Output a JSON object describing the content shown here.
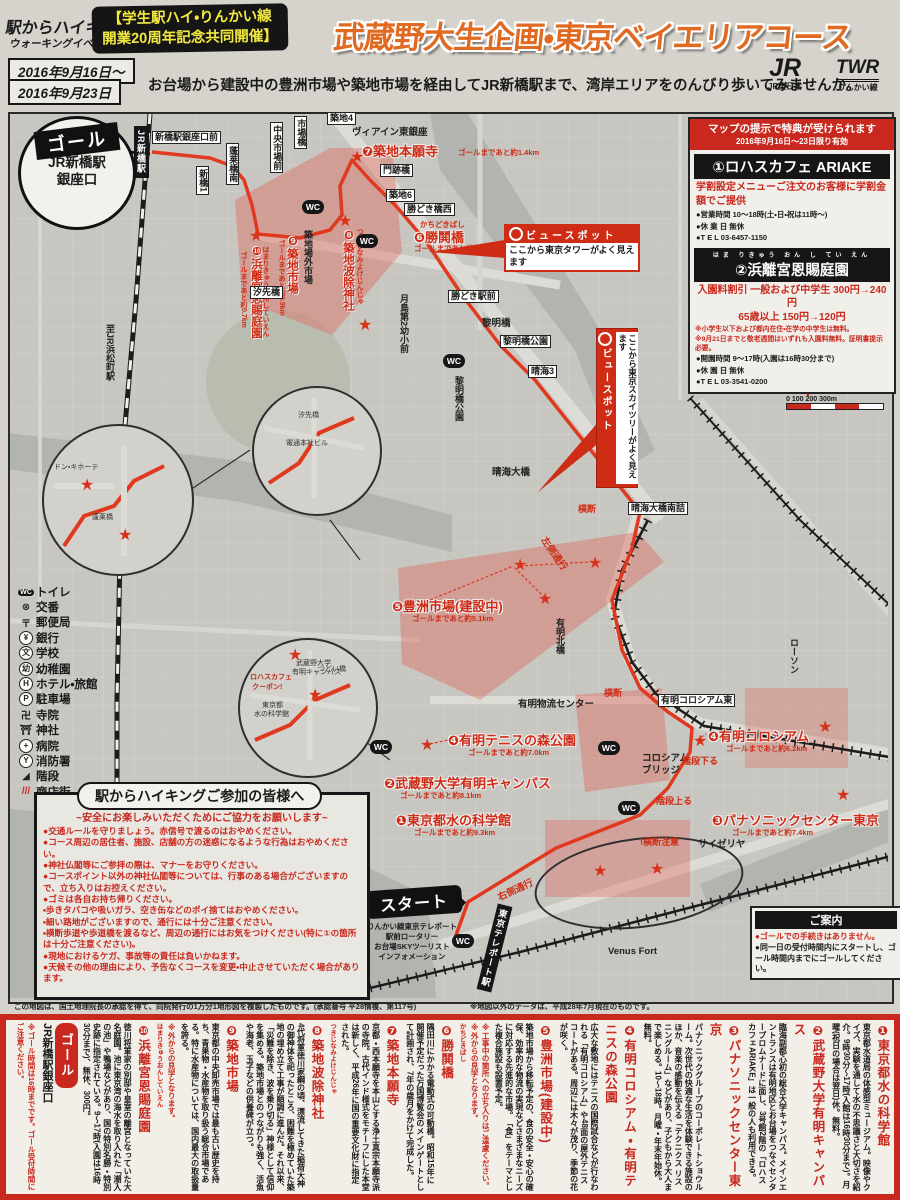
{
  "header": {
    "logo_line1": "駅からハイキング&",
    "logo_line2": "ウォーキングイベント",
    "coop_line1": "【学生駅ハイ・りんかい線",
    "coop_line2": "開業20周年記念共同開催】",
    "title": "武蔵野大生企画・東京ベイエリアコース",
    "date_line1": "2016年9月16日〜",
    "date_line2": "2016年9月23日",
    "subtitle": "お台場から建設中の豊洲市場や築地市場を経由してJR新橋駅まで、湾岸エリアをのんびり歩いてみませんか。",
    "jr_mark": "JR",
    "jr_label": "JR東日本",
    "twr_mark": "TWR",
    "twr_label": "りんかい線"
  },
  "promo": {
    "header_line1": "マップの提示で特典が受けられます",
    "header_line2": "2016年9月16日〜23日限り有効",
    "shop1_title": "①ロハスカフェ ARIAKE",
    "shop1_offer": "学割設定メニューご注文のお客様に学割金額でご提供",
    "shop1_hours": "●営業時間 10〜18時(土・日・祝は11時〜)",
    "shop1_closed": "●休 業 日 無休",
    "shop1_tel": "●T E L 03-6457-1150",
    "shop2_furigana": "はま りきゅう おん し てい えん",
    "shop2_title": "②浜離宮恩賜庭園",
    "shop2_offer1": "入園料割引 一般および中学生 300円→240円",
    "shop2_offer2": "65歳以上 150円→120円",
    "shop2_note1": "※小学生以下および都内在住・在学の中学生は無料。",
    "shop2_note2": "※9月21日までと敬老週間はいずれも入園料無料。証明書提示必要。",
    "shop2_hours": "●開園時間 9〜17時(入園は16時30分まで)",
    "shop2_closed": "●休 園 日 無休",
    "shop2_tel": "●T E L 03-3541-0200"
  },
  "goal_callout": {
    "badge": "ゴール",
    "line1": "JR新橋駅",
    "line2": "銀座口"
  },
  "start_callout": {
    "badge": "スタート",
    "sub1": "りんかい線東京テレポート",
    "sub2": "駅前ロータリー",
    "sub3": "お台場SKYツーリスト",
    "sub4": "インフォメーション"
  },
  "viewspot1": {
    "title": "ビュースポット",
    "body": "ここから東京タワーがよく見えます"
  },
  "viewspot2": {
    "title": "ビュースポット",
    "body": "ここから東京スカイツリーがよく見えます"
  },
  "compass": {
    "label": "北"
  },
  "scale": {
    "ticks": "0   100   200  300m"
  },
  "legend": {
    "items": [
      {
        "icon": "WC",
        "label": "トイレ"
      },
      {
        "icon": "⊗",
        "label": "交番"
      },
      {
        "icon": "〒",
        "label": "郵便局"
      },
      {
        "icon": "¥",
        "label": "銀行"
      },
      {
        "icon": "文",
        "label": "学校"
      },
      {
        "icon": "幼",
        "label": "幼稚園"
      },
      {
        "icon": "H",
        "label": "ホテル・旅館"
      },
      {
        "icon": "P",
        "label": "駐車場"
      },
      {
        "icon": "卍",
        "label": "寺院"
      },
      {
        "icon": "⛩",
        "label": "神社"
      },
      {
        "icon": "+",
        "label": "病院"
      },
      {
        "icon": "Y",
        "label": "消防署"
      },
      {
        "icon": "◢",
        "label": "階段"
      },
      {
        "icon": "///",
        "label": "商店街"
      }
    ]
  },
  "safety": {
    "title": "駅からハイキングご参加の皆様へ",
    "subtitle": "~安全にお楽しみいただくためにご協力をお願いします~",
    "bullets": [
      "●交通ルールを守りましょう。赤信号で渡るのはおやめください。",
      "●コース周辺の居住者、施設、店舗の方の迷惑になるような行為はおやめください。",
      "●神社仏閣等にご参拝の際は、マナーをお守りください。",
      "●コースポイント以外の神社仏閣等については、行事のある場合がございますので、立ち入りはお控えください。",
      "●ゴミは各自お持ち帰りください。",
      "・歩きタバコや吸いガラ、空き缶などのポイ捨てはおやめください。",
      "・細い路地がございますので、通行には十分ご注意ください。",
      "・横断歩道や歩道橋を渡るなど、周辺の通行にはお気をつけください(特に①の箇所は十分ご注意ください)。",
      "●現地におけるケガ、事故等の責任は負いかねます。",
      "●天候その他の理由により、予告なくコースを変更・中止させていただく場合があります。"
    ]
  },
  "guide": {
    "title": "ご案内",
    "line1": "●ゴールでの手続きはありません。",
    "line2": "●同一日の受付時間内にスタートし、ゴール時間内までにゴールしてください。"
  },
  "map_notes": {
    "left": "この地図は、国土地理院長の承認を得て、同院発行の1万分1地形図を複製したものです。(承認番号 平28情複、第117号)",
    "right": "※地図以外のデータは、平成28年7月現在のものです。"
  },
  "map": {
    "labels": [
      {
        "t": "新橋駅銀座口前",
        "x": 152,
        "y": 131,
        "s": "box"
      },
      {
        "t": "新橋1",
        "x": 196,
        "y": 166,
        "s": "vbox"
      },
      {
        "t": "蓬莱橋南",
        "x": 226,
        "y": 143,
        "s": "vbox"
      },
      {
        "t": "中央市場前",
        "x": 270,
        "y": 122,
        "s": "vbox"
      },
      {
        "t": "市場橋",
        "x": 294,
        "y": 116,
        "s": "vbox"
      },
      {
        "t": "築地4",
        "x": 327,
        "y": 112,
        "s": "box"
      },
      {
        "t": "ヴィアイン東銀座",
        "x": 352,
        "y": 124,
        "s": "plain"
      },
      {
        "t": "❼築地本願寺",
        "x": 362,
        "y": 141,
        "s": "red"
      },
      {
        "t": "ゴールまであと約1.4km",
        "x": 458,
        "y": 147,
        "s": "redsub"
      },
      {
        "t": "門跡橋",
        "x": 380,
        "y": 164,
        "s": "box"
      },
      {
        "t": "築地6",
        "x": 386,
        "y": 189,
        "s": "box"
      },
      {
        "t": "勝どき橋西",
        "x": 404,
        "y": 203,
        "s": "box"
      },
      {
        "t": "かちどきばし",
        "x": 420,
        "y": 219,
        "s": "redsub"
      },
      {
        "t": "❻勝鬨橋",
        "x": 414,
        "y": 227,
        "s": "red"
      },
      {
        "t": "ゴールまであと約2.4km",
        "x": 414,
        "y": 243,
        "s": "redsub"
      },
      {
        "t": "築地場外市場",
        "x": 302,
        "y": 230,
        "s": "vplain"
      },
      {
        "t": "つきじなみよけじんじゃ",
        "x": 354,
        "y": 228,
        "s": "vredsub"
      },
      {
        "t": "❽築地波除神社",
        "x": 340,
        "y": 228,
        "s": "vred"
      },
      {
        "t": "❾築地市場",
        "x": 284,
        "y": 234,
        "s": "vred"
      },
      {
        "t": "ゴールまであと約0.9km",
        "x": 276,
        "y": 240,
        "s": "vredsub"
      },
      {
        "t": "はまりきゅうおんしていえん",
        "x": 260,
        "y": 246,
        "s": "vredsub"
      },
      {
        "t": "❿浜離宮恩賜庭園",
        "x": 248,
        "y": 244,
        "s": "vred"
      },
      {
        "t": "ゴールまであと約0.7km",
        "x": 238,
        "y": 252,
        "s": "vredsub"
      },
      {
        "t": "汐先橋",
        "x": 250,
        "y": 286,
        "s": "box"
      },
      {
        "t": "月島第2幼小前",
        "x": 398,
        "y": 294,
        "s": "vplain"
      },
      {
        "t": "勝どき駅前",
        "x": 448,
        "y": 290,
        "s": "box"
      },
      {
        "t": "黎明橋",
        "x": 482,
        "y": 315,
        "s": "plain"
      },
      {
        "t": "黎明橋公園",
        "x": 500,
        "y": 335,
        "s": "box"
      },
      {
        "t": "黎明橋公園",
        "x": 453,
        "y": 376,
        "s": "vplain"
      },
      {
        "t": "晴海3",
        "x": 528,
        "y": 365,
        "s": "box"
      },
      {
        "t": "晴海大橋",
        "x": 492,
        "y": 464,
        "s": "plain"
      },
      {
        "t": "横断",
        "x": 578,
        "y": 502,
        "s": "redsmall"
      },
      {
        "t": "晴海大橋南詰",
        "x": 628,
        "y": 502,
        "s": "box"
      },
      {
        "t": "❺豊洲市場(建設中)",
        "x": 392,
        "y": 596,
        "s": "red"
      },
      {
        "t": "ゴールまであと約5.1km",
        "x": 412,
        "y": 613,
        "s": "redsub"
      },
      {
        "t": "左側通行",
        "x": 536,
        "y": 546,
        "s": "redrot",
        "r": 55
      },
      {
        "t": "有明北橋",
        "x": 554,
        "y": 618,
        "s": "vplain"
      },
      {
        "t": "ローソン",
        "x": 788,
        "y": 638,
        "s": "vplain"
      },
      {
        "t": "有明物流センター",
        "x": 518,
        "y": 696,
        "s": "plain"
      },
      {
        "t": "横断",
        "x": 604,
        "y": 686,
        "s": "redsmall"
      },
      {
        "t": "有明コロシアム東",
        "x": 658,
        "y": 694,
        "s": "box"
      },
      {
        "t": "❹有明テニスの森公園",
        "x": 448,
        "y": 730,
        "s": "red"
      },
      {
        "t": "ゴールまであと約7.0km",
        "x": 468,
        "y": 747,
        "s": "redsub"
      },
      {
        "t": "❷武蔵野大学有明キャンパス",
        "x": 384,
        "y": 773,
        "s": "red"
      },
      {
        "t": "ゴールまであと約8.1km",
        "x": 400,
        "y": 790,
        "s": "redsub"
      },
      {
        "t": "❶東京都水の科学館",
        "x": 396,
        "y": 810,
        "s": "red"
      },
      {
        "t": "ゴールまであと約9.3km",
        "x": 414,
        "y": 827,
        "s": "redsub"
      },
      {
        "t": "コロシアム",
        "x": 642,
        "y": 750,
        "s": "plain"
      },
      {
        "t": "ブリッジ",
        "x": 642,
        "y": 762,
        "s": "plain"
      },
      {
        "t": "❹有明コロシアム",
        "x": 708,
        "y": 726,
        "s": "red"
      },
      {
        "t": "ゴールまであと約6.2km",
        "x": 726,
        "y": 743,
        "s": "redsub"
      },
      {
        "t": "階段下る",
        "x": 682,
        "y": 754,
        "s": "redsmall"
      },
      {
        "t": "階段上る",
        "x": 656,
        "y": 794,
        "s": "redsmall"
      },
      {
        "t": "!横断注意",
        "x": 640,
        "y": 835,
        "s": "redsmall"
      },
      {
        "t": "❸パナソニックセンター東京",
        "x": 712,
        "y": 810,
        "s": "red"
      },
      {
        "t": "ゴールまであと約7.4km",
        "x": 732,
        "y": 827,
        "s": "redsub"
      },
      {
        "t": "サイゼリヤ",
        "x": 698,
        "y": 836,
        "s": "plain"
      },
      {
        "t": "右側通行",
        "x": 496,
        "y": 882,
        "s": "redrot",
        "r": -25
      },
      {
        "t": "Venus Fort",
        "x": 608,
        "y": 946,
        "s": "plain"
      },
      {
        "t": "至JR浜松町駅",
        "x": 104,
        "y": 324,
        "s": "vplain"
      },
      {
        "t": "東京テレポート駅",
        "x": 487,
        "y": 904,
        "s": "vstation",
        "r": 14
      },
      {
        "t": "JR新橋駅",
        "x": 134,
        "y": 126,
        "s": "vstation"
      },
      {
        "t": "ドン・キホーテ",
        "x": 54,
        "y": 462,
        "s": "tiny"
      },
      {
        "t": "蓬莱橋",
        "x": 92,
        "y": 512,
        "s": "tiny"
      },
      {
        "t": "電通本社ビル",
        "x": 286,
        "y": 438,
        "s": "tiny"
      },
      {
        "t": "汐先橋",
        "x": 298,
        "y": 410,
        "s": "tiny"
      },
      {
        "t": "武蔵野大学",
        "x": 296,
        "y": 658,
        "s": "tiny"
      },
      {
        "t": "有明キャンパス",
        "x": 292,
        "y": 667,
        "s": "tiny"
      },
      {
        "t": "ロハスカフェ",
        "x": 250,
        "y": 672,
        "s": "tinyred"
      },
      {
        "t": "クーポン!",
        "x": 252,
        "y": 682,
        "s": "tinyred"
      },
      {
        "t": "東京都",
        "x": 262,
        "y": 700,
        "s": "tiny"
      },
      {
        "t": "水の科学館",
        "x": 254,
        "y": 709,
        "s": "tiny"
      },
      {
        "t": "つどい橋",
        "x": 318,
        "y": 664,
        "s": "tiny"
      },
      {
        "t": "★",
        "x": 249,
        "y": 229,
        "s": "star"
      },
      {
        "t": "★",
        "x": 338,
        "y": 214,
        "s": "star"
      },
      {
        "t": "★",
        "x": 350,
        "y": 150,
        "s": "star"
      },
      {
        "t": "★",
        "x": 358,
        "y": 318,
        "s": "star"
      },
      {
        "t": "★",
        "x": 513,
        "y": 558,
        "s": "star"
      },
      {
        "t": "★",
        "x": 588,
        "y": 556,
        "s": "star"
      },
      {
        "t": "★",
        "x": 538,
        "y": 592,
        "s": "star"
      },
      {
        "t": "★",
        "x": 420,
        "y": 738,
        "s": "star"
      },
      {
        "t": "★",
        "x": 693,
        "y": 734,
        "s": "star"
      },
      {
        "t": "★",
        "x": 818,
        "y": 720,
        "s": "star"
      },
      {
        "t": "★",
        "x": 593,
        "y": 864,
        "s": "star"
      },
      {
        "t": "★",
        "x": 650,
        "y": 862,
        "s": "star"
      },
      {
        "t": "★",
        "x": 836,
        "y": 788,
        "s": "star"
      },
      {
        "t": "★",
        "x": 80,
        "y": 478,
        "s": "star"
      },
      {
        "t": "★",
        "x": 118,
        "y": 528,
        "s": "star"
      },
      {
        "t": "★",
        "x": 288,
        "y": 648,
        "s": "star"
      },
      {
        "t": "★",
        "x": 308,
        "y": 688,
        "s": "star"
      },
      {
        "t": "WC",
        "x": 302,
        "y": 200,
        "s": "wc"
      },
      {
        "t": "WC",
        "x": 356,
        "y": 234,
        "s": "wc"
      },
      {
        "t": "WC",
        "x": 443,
        "y": 354,
        "s": "wc"
      },
      {
        "t": "WC",
        "x": 598,
        "y": 741,
        "s": "wc"
      },
      {
        "t": "WC",
        "x": 618,
        "y": 801,
        "s": "wc"
      },
      {
        "t": "WC",
        "x": 452,
        "y": 934,
        "s": "wc"
      },
      {
        "t": "WC",
        "x": 370,
        "y": 740,
        "s": "wc"
      }
    ]
  },
  "course_points": {
    "header": "●コースのポイント",
    "stat1_label": "歩行時間",
    "stat1_value": "約2時間20分",
    "stat2_label": "歩行距離",
    "stat2_value": "約9.5km",
    "note": "※地図中の数字はコースポイントに対応しています。",
    "start_badge": "スタート",
    "start_desc": "りんかい線東京テレポート駅前ロータリー お台場SKYツーリスト インフォメーション",
    "items": [
      {
        "num": "❶",
        "name": "東京都水の科学館",
        "desc": "東京都水道局の体感型ミュージアム。映像やクイズ、実験を通して水の不思議さと大切さを紹介。9時30分〜17時(入館は16時30分まで)。月曜(祝日の場合は翌日)休。無料。"
      },
      {
        "num": "❷",
        "name": "武蔵野大学有明キャンパス",
        "desc": "臨海副都心初の総合大学キャンパス。メインエントランスは有明地区とお台場をつなぐセンタープロムナードに面し、3号館2階の「ロハスカフェARIAKE」は一般の人も利用できる。"
      },
      {
        "num": "❸",
        "name": "パナソニックセンター東京",
        "desc": "パナソニックグループのコーポレートショウルーム。次世代の快適な生活を体験できる施設のほか、音楽の感動を伝える「テクニクス リスニングルーム」などがあり、子どもから大人まで楽しめる。10〜18時。月曜・年末年始休。無料。"
      },
      {
        "num": "❹",
        "name": "有明コロシアム・有明テニスの森公園",
        "desc": "広大な敷地にはテニスの国際試合などが行なわれる「有明コロシアム」や48面の屋外テニスコートがある。周辺には木々が茂り、季節の花が咲く。"
      },
      {
        "num": "❺",
        "name": "豊洲市場(建設中)",
        "desc": "築地市場から移転予定の、食の安全・安心の確保、効率的な物流の実現などさまざまなニーズに対応する先進的な市場。「食」をテーマとした複合施設も設置予定。",
        "note": "※工事中の箇所への立ち入りはご遠慮ください。※外からの見学となります。"
      },
      {
        "num": "❻",
        "name": "勝鬨橋",
        "furigana": "かちどきばし",
        "desc": "隅田川にかかる電動式の可動橋。昭和15年に開催予定だった万国博覧会のメインゲートとして計画され、7年の歳月をかけて完成した。"
      },
      {
        "num": "❼",
        "name": "築地本願寺",
        "desc": "京都・西本願寺を本山とする浄土真宗本願寺派の寺院。古代インド様式をモチーフにした本堂は新しく、平成26年に国の重要文化財に指定された。"
      },
      {
        "num": "❽",
        "name": "築地波除神社",
        "furigana": "つきじなみよけじんじゃ",
        "desc": "4代将軍徳川家綱の頃、漂流してきた稲荷大神の御神体を祀ったところ、困難を極めていた築地の埋め立て工事が順調に進んだ。それ以来、「災難を除き、波を乗り切る」神様として信仰を集める。築地市場とのつながりも強く、活魚や海老、玉子などの供養碑が立つ。"
      },
      {
        "num": "❾",
        "name": "築地市場",
        "desc": "東京都の中央卸売市場では最も古い歴史を持ち、青果物・水産物を取り扱う総合市場である。特に水産物については、国内最大の取扱量を誇る。",
        "note": "※外からの見学となります。"
      },
      {
        "num": "❿",
        "name": "浜離宮恩賜庭園",
        "furigana": "はまりきゅうおんしていえん",
        "desc": "徳川将軍家の別邸や皇室の離宮となっていた大名庭園。池に東京湾の海水を取り入れた「潮入の池」や鴨場などがあり、国の特別名勝・特別史跡に指定されている。9〜17時(入園は16時30分まで)、無休、300円。"
      }
    ],
    "goal_badge": "ゴール",
    "goal_desc": "JR新橋駅銀座口",
    "goal_note": "※ゴール時間は16時までです。ゴール受付時間にご注意ください。"
  }
}
